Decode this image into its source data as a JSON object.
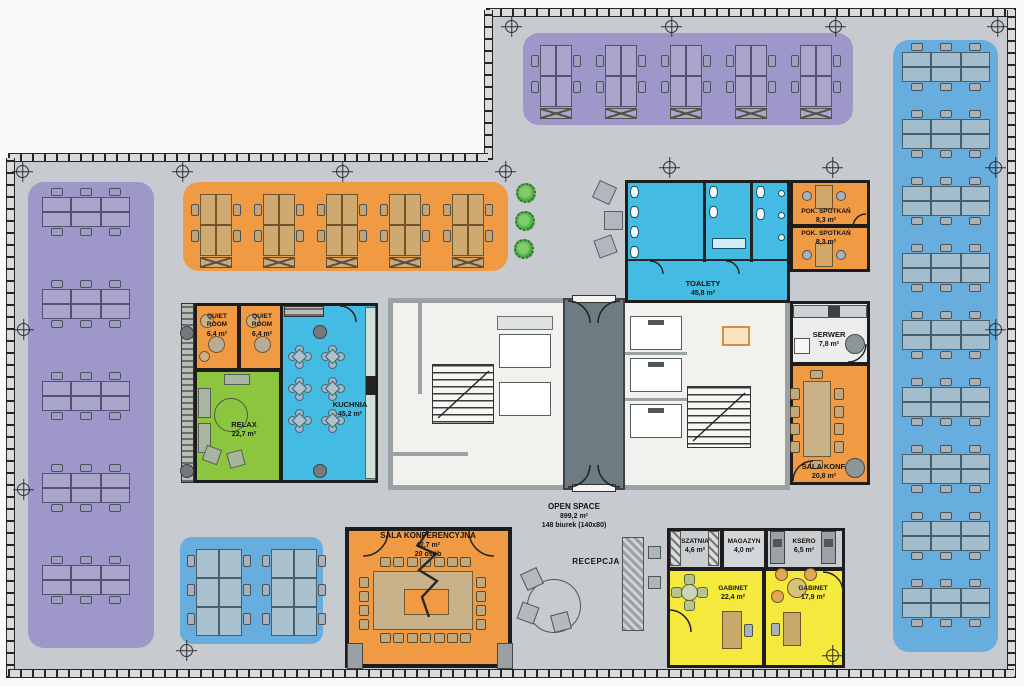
{
  "open_space": {
    "name": "OPEN SPACE",
    "area": "899,2 m²",
    "desks": "148 biurek (140x80)"
  },
  "reception": {
    "name": "RECEPCJA"
  },
  "rooms": {
    "quiet1": {
      "name": "QUIET ROOM",
      "area": "6,4 m²"
    },
    "quiet2": {
      "name": "QUIET ROOM",
      "area": "6,4 m²"
    },
    "relax": {
      "name": "RELAX",
      "area": "22,7 m²"
    },
    "kuchnia": {
      "name": "KUCHNIA",
      "area": "45,2 m²"
    },
    "toalety": {
      "name": "TOALETY",
      "area": "45,8 m²"
    },
    "pok_spotkan1": {
      "name": "POK. SPOTKAŃ",
      "area": "8,3 m²"
    },
    "pok_spotkan2": {
      "name": "POK. SPOTKAŃ",
      "area": "8,3 m²"
    },
    "serwer": {
      "name": "SERWER",
      "area": "7,8 m²"
    },
    "sala_konf": {
      "name": "SALA KONF.",
      "area": "20,8 m²"
    },
    "sala_konferencyjna": {
      "name": "SALA KONFERENCYJNA",
      "area": "42,7 m²",
      "capacity": "20 osób"
    },
    "szatnia": {
      "name": "SZATNIA",
      "area": "4,6 m²"
    },
    "magazyn": {
      "name": "MAGAZYN",
      "area": "4,0 m²"
    },
    "ksero": {
      "name": "KSERO",
      "area": "6,5 m²"
    },
    "gabinet1": {
      "name": "GABINET",
      "area": "22,4 m²"
    },
    "gabinet2": {
      "name": "GABINET",
      "area": "17,9 m²"
    }
  },
  "colors": {
    "floor": "#c7cbcf",
    "wall": "#1d1d1d",
    "zone_purple": "#9d98c9",
    "zone_orange": "#f19a44",
    "zone_blue": "#67aede",
    "cyan": "#44bbe2",
    "green": "#8cc63f",
    "yellow": "#f5e93e",
    "core": "#f2f1ed",
    "lobby": "#6d7b83",
    "core_wall": "#9ba2a6",
    "desk_tan": "#d0a970",
    "table_tan": "#c9b189"
  },
  "furniture": {
    "bench_rows": [
      [
        42,
        197,
        "purple"
      ],
      [
        42,
        289,
        "purple"
      ],
      [
        42,
        381,
        "purple"
      ],
      [
        42,
        473,
        "purple"
      ],
      [
        42,
        565,
        "purple"
      ],
      [
        902,
        52,
        "blue"
      ],
      [
        902,
        119,
        "blue"
      ],
      [
        902,
        186,
        "blue"
      ],
      [
        902,
        253,
        "blue"
      ],
      [
        902,
        320,
        "blue"
      ],
      [
        902,
        387,
        "blue"
      ],
      [
        902,
        454,
        "blue"
      ],
      [
        902,
        521,
        "blue"
      ],
      [
        902,
        588,
        "blue"
      ]
    ],
    "clusters": [
      [
        540,
        45,
        "purple"
      ],
      [
        605,
        45,
        "purple"
      ],
      [
        670,
        45,
        "purple"
      ],
      [
        735,
        45,
        "purple"
      ],
      [
        800,
        45,
        "purple"
      ],
      [
        200,
        194,
        "orange"
      ],
      [
        263,
        194,
        "orange"
      ],
      [
        326,
        194,
        "orange"
      ],
      [
        389,
        194,
        "orange"
      ],
      [
        452,
        194,
        "orange"
      ]
    ],
    "bench_cols": [
      [
        196,
        549
      ],
      [
        271,
        549
      ]
    ],
    "kitchen_tables": [
      [
        300,
        357
      ],
      [
        333,
        357
      ],
      [
        300,
        389
      ],
      [
        333,
        389
      ],
      [
        300,
        421
      ],
      [
        333,
        421
      ]
    ],
    "grid_marks": [
      [
        23,
        172
      ],
      [
        183,
        172
      ],
      [
        343,
        172
      ],
      [
        506,
        172
      ],
      [
        670,
        168
      ],
      [
        833,
        168
      ],
      [
        512,
        27
      ],
      [
        672,
        27
      ],
      [
        836,
        27
      ],
      [
        998,
        27
      ],
      [
        24,
        330
      ],
      [
        24,
        490
      ],
      [
        996,
        168
      ],
      [
        996,
        330
      ],
      [
        187,
        651
      ],
      [
        833,
        656
      ]
    ],
    "plants": [
      [
        516,
        183
      ],
      [
        515,
        211
      ],
      [
        514,
        239
      ]
    ],
    "lounge_seats": [
      [
        595,
        183,
        25
      ],
      [
        604,
        211,
        0
      ],
      [
        596,
        237,
        -20
      ]
    ],
    "conf_big": {
      "top": 7,
      "bottom": 7,
      "left": 4,
      "right": 4
    },
    "conf_small": {
      "left": 4,
      "right": 4
    }
  }
}
